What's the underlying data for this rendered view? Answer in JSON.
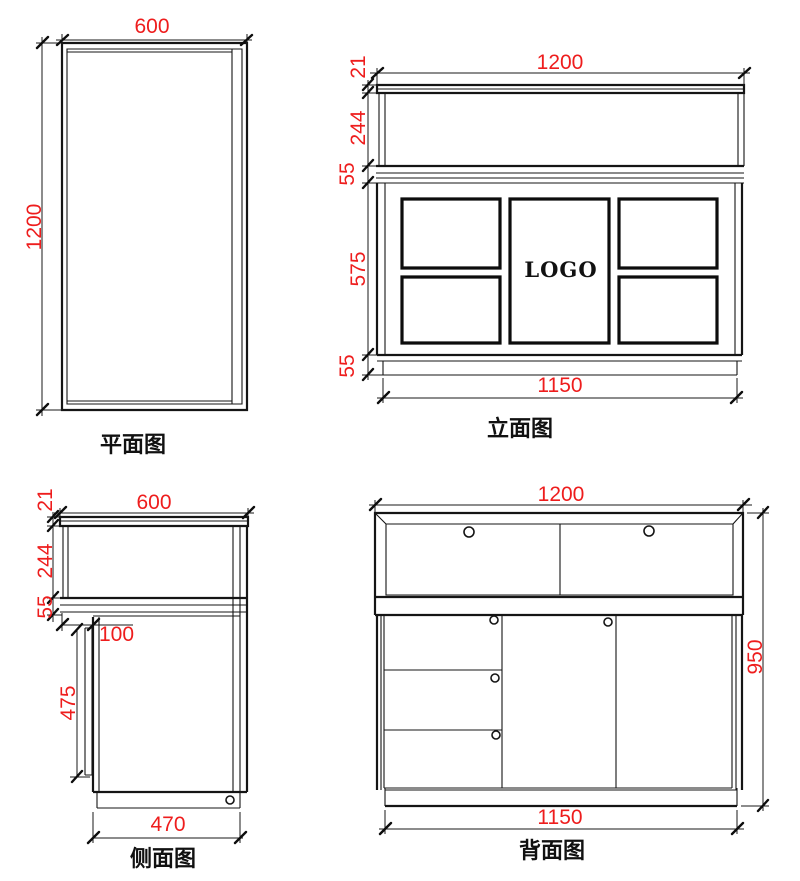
{
  "drawing": {
    "background": "#ffffff",
    "line_color": "#151515",
    "dim_color": "#ee1d1d",
    "views": {
      "plan": {
        "title": "平面图",
        "dims": {
          "width": "600",
          "depth": "1200"
        }
      },
      "elevation": {
        "title": "立面图",
        "logo": "LOGO",
        "dims": {
          "top_width": "1200",
          "bottom_width": "1150",
          "chain": [
            "21",
            "244",
            "55",
            "575",
            "55"
          ]
        }
      },
      "side": {
        "title": "侧面图",
        "dims": {
          "top_width": "600",
          "chain": [
            "21",
            "244",
            "55"
          ],
          "offset": "100",
          "back_panel": "475",
          "bottom_width": "470"
        }
      },
      "back": {
        "title": "背面图",
        "dims": {
          "top_width": "1200",
          "height": "950",
          "bottom_width": "1150"
        }
      }
    }
  }
}
